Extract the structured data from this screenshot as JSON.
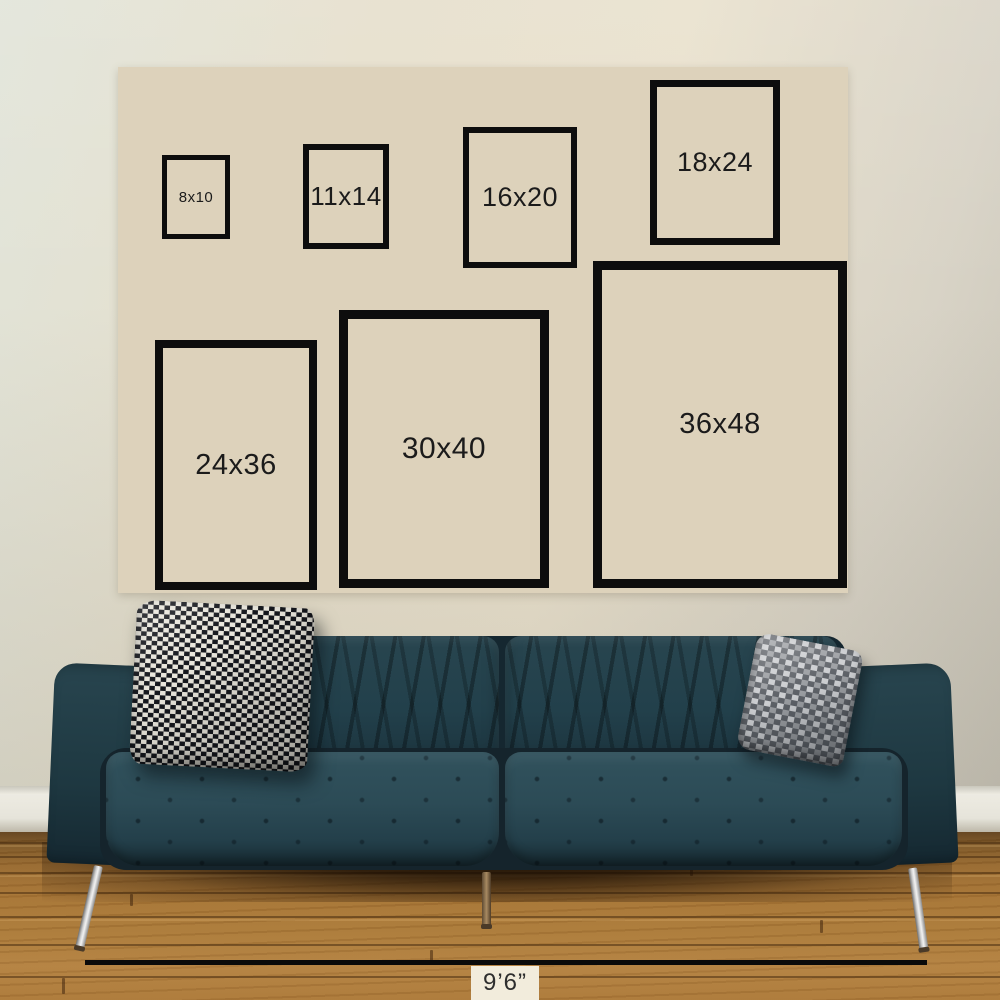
{
  "size_chart": {
    "sizes": [
      {
        "label": "8x10",
        "width_in": 8,
        "height_in": 10
      },
      {
        "label": "11x14",
        "width_in": 11,
        "height_in": 14
      },
      {
        "label": "16x20",
        "width_in": 16,
        "height_in": 20
      },
      {
        "label": "18x24",
        "width_in": 18,
        "height_in": 24
      },
      {
        "label": "24x36",
        "width_in": 24,
        "height_in": 36
      },
      {
        "label": "30x40",
        "width_in": 30,
        "height_in": 40
      },
      {
        "label": "36x48",
        "width_in": 36,
        "height_in": 48
      }
    ]
  },
  "measurement": {
    "label": "9’6”"
  },
  "chart_data": {
    "type": "table",
    "labels": [
      "8x10",
      "11x14",
      "16x20",
      "18x24",
      "24x36",
      "30x40",
      "36x48"
    ],
    "sizes_in": [
      [
        8,
        10
      ],
      [
        11,
        14
      ],
      [
        16,
        20
      ],
      [
        18,
        24
      ],
      [
        24,
        36
      ],
      [
        30,
        40
      ],
      [
        36,
        48
      ]
    ],
    "room_width_label": "9’6”"
  },
  "colors": {
    "wall_a": "#e1e4d9",
    "wall_b": "#e6dfcc",
    "wall_c": "#e9e1cd",
    "wall_d": "#d8d3c6",
    "wall_e": "#c5c1b4",
    "panel_bg": "#ddd2bb",
    "frame_border": "#0d0d0d",
    "size_text": "#1b1b1b",
    "baseboard": "#edebe2",
    "floor_a": "#5f3f1c",
    "floor_b": "#96682f",
    "floor_c": "#aa7938",
    "floor_d": "#b28040",
    "sofa_body": "#22404b",
    "sofa_arm": "#1e3841",
    "sofa_seat": "#2c4b56",
    "pillow1_a": "#15171d",
    "pillow1_b": "#e9e6dc",
    "pillow2_a": "#5d6167",
    "pillow2_b": "#cbcdd0",
    "measure_line": "#0a0a0a",
    "measure_bg": "#f2ecdc",
    "measure_text": "#2e2e2e"
  }
}
